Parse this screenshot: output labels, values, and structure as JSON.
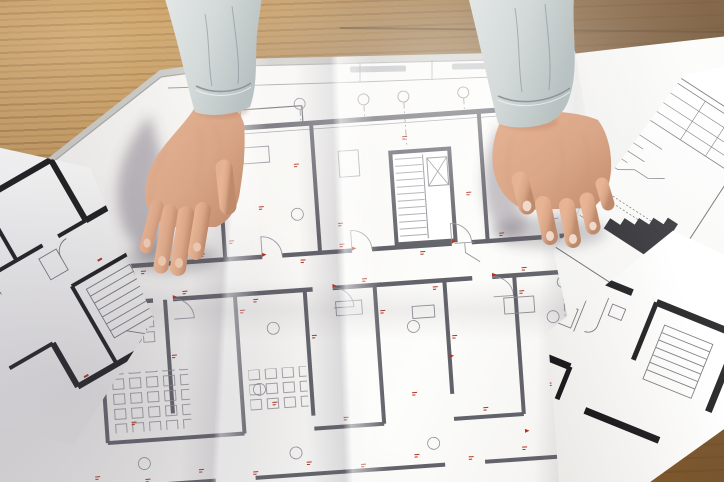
{
  "scene": {
    "type": "photograph",
    "view": "top-down",
    "description": "Two hands in light grey shirt sleeves resting on unfolded architectural floor-plan blueprints spread over a wooden desk",
    "legible_text": "none — all drawing annotations are too small to read and partly upside-down"
  },
  "objects": {
    "desk": {
      "label": "wooden desk surface",
      "material": "oak wood with horizontal grain",
      "base_color": "#b98a52"
    },
    "main_blueprint": {
      "label": "large unfolded floor-plan blueprint",
      "paper_color": "#f6f5f2",
      "line_color": "#62626a",
      "annotation_color": "#b23222",
      "features": [
        "multi-room floor plan",
        "stair and elevator core",
        "door swing arcs",
        "furniture/desk symbols",
        "red dimension annotations",
        "grid axis markers",
        "dash-dot reference lines",
        "fold creases",
        "upside-down title strip along top edge"
      ],
      "red_annotation_marks_approx": 54,
      "grid_axis_markers": 5
    },
    "left_sheet": {
      "label": "small tilted sheet with bold black apartment plan",
      "line_color": "#1b1b1d"
    },
    "title_sheet": {
      "label": "tilted technical sheet with title-block table and stair section",
      "line_color": "#6a6a70"
    },
    "bottom_right_sheet": {
      "label": "tilted sheet with bold black unit plan and stair treads",
      "line_color": "#1b1b1d"
    },
    "spiral_notebook": {
      "label": "spiral-bound notepad behind sheets",
      "coil_color": "#26262b",
      "visible_coils": 9
    },
    "left_arm": {
      "label": "left forearm and hand",
      "garment": "light grey shirt sleeve with cuff",
      "sleeve_color": "#d4dad9",
      "skin_tone": "#d9a687"
    },
    "right_arm": {
      "label": "right forearm and hand",
      "garment": "light grey shirt sleeve with cuff",
      "sleeve_color": "#d4dad9",
      "skin_tone": "#d9a687"
    }
  },
  "lighting": {
    "key_light": "bright daylight from upper right",
    "shadows": "soft hand shadows cast left of each hand, broad shade lower-left"
  },
  "palette": {
    "wood_light": "#c89d63",
    "wood_dark": "#6f4a21",
    "paper": "#f6f5f2",
    "plan_gray": "#62626a",
    "plan_thin": "#9a9aa2",
    "annotation_red": "#b23222",
    "sleeve_grey": "#d4dad9",
    "skin": "#d9a687"
  }
}
